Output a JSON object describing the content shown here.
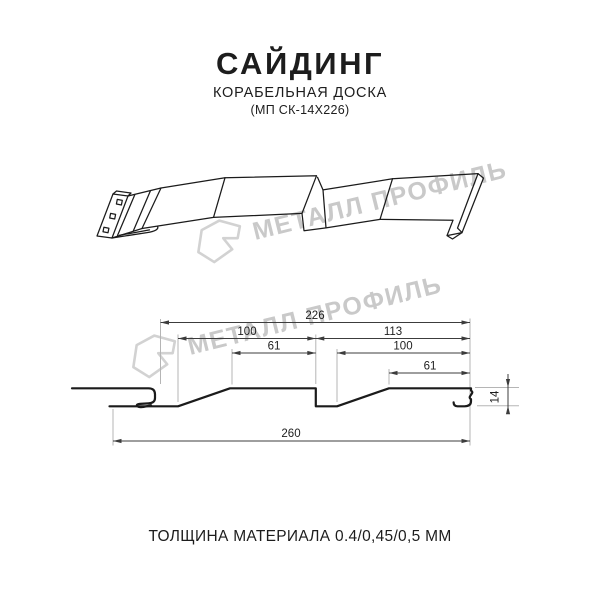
{
  "header": {
    "title": "САЙДИНГ",
    "subtitle": "КОРАБЕЛЬНАЯ ДОСКА",
    "model_code": "(МП СК-14Х226)"
  },
  "watermark": {
    "brand": "МЕТАЛЛ ПРОФИЛЬ"
  },
  "diagram": {
    "dim_overall_width": "226",
    "dim_left_board": "100",
    "dim_right_board": "113",
    "dim_left_flat": "61",
    "dim_right_inner": "100",
    "dim_right_flat": "61",
    "dim_total_width": "260",
    "dim_profile_height": "14"
  },
  "footer": {
    "thickness": "ТОЛЩИНА МАТЕРИАЛА 0.4/0,45/0,5 ММ"
  },
  "colors": {
    "line": "#1b1b1b",
    "dimension": "#3c3c3c",
    "label": "#1e1e1e",
    "extension": "#b5b5b5",
    "watermark_text": "#c9c9c9",
    "watermark_logo": "#d2d2d2",
    "background": "#ffffff"
  }
}
